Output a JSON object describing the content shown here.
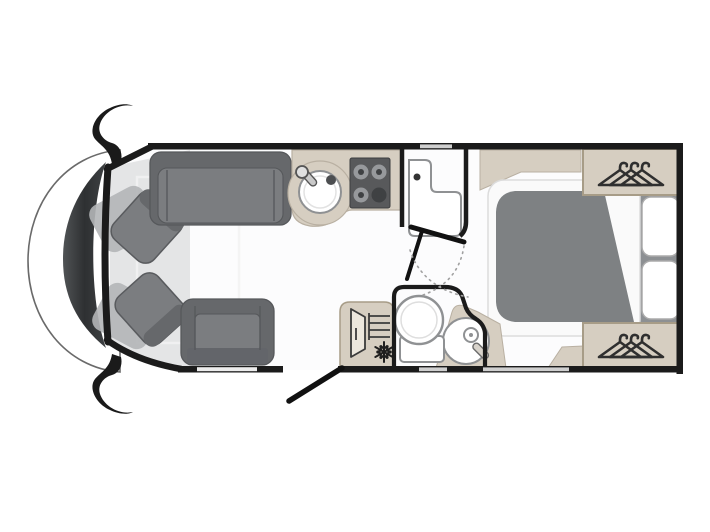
{
  "app": {
    "name": "Motorhome floor plan",
    "description": "Top-down 2D layout drawing of a coachbuilt motorhome: driver cab with two swivel seats on the left, front lounge with sofa and travel seat, mid kitchenette with round sink and 4-burner hob, central washroom with corner basin, shower room with toilet, shower and fridge, rear bedroom with island bed, two pillows and two wardrobes with clothes hangers, open habitation entry door at the bottom"
  },
  "colors": {
    "background": "#ffffff",
    "wall": "#1b1b1b",
    "window": "#cfcfcf",
    "window_light": "#ececec",
    "floor": "#fcfcfd",
    "cab_floor": "#e4e5e6",
    "windshield": "#3e4042",
    "furniture_dark": "#66686b",
    "furniture_mid": "#7b7d80",
    "furniture_ghost": "#b3b5b7",
    "cabinet": "#d6cec1",
    "cabinet_border": "#a79c87",
    "fixture_white": "#ffffff",
    "fixture_stroke": "#8f9193",
    "bed_duvet": "#7e8183",
    "bed_panel": "#8d9093",
    "bed_mattress": "#fafafa",
    "hob": "#58595b",
    "burner_ring": "#97999c",
    "burner_dot": "#3f4143",
    "icon_stroke": "#2f2f2f",
    "arc_dotted": "#a0a0a0"
  },
  "zones": [
    {
      "id": "cab",
      "label": "Driver cab",
      "items": [
        "windshield-dashboard",
        "side-mirror-top",
        "side-mirror-bottom",
        "swivel-seat-top",
        "swivel-seat-bottom"
      ]
    },
    {
      "id": "lounge",
      "label": "Front lounge",
      "items": [
        "sofa-bench",
        "travel-seat"
      ]
    },
    {
      "id": "kitchen",
      "label": "Kitchenette",
      "items": [
        "worktop",
        "round-sink",
        "hob-4-burner"
      ]
    },
    {
      "id": "washroom",
      "label": "Washroom",
      "items": [
        "corner-vanity-basin",
        "swing-door",
        "door-swing-arcs"
      ]
    },
    {
      "id": "shower-room",
      "label": "Shower room",
      "items": [
        "fridge-with-snowflake",
        "toilet",
        "shower-with-handset"
      ]
    },
    {
      "id": "bedroom",
      "label": "Rear bedroom",
      "items": [
        "island-bed-with-duvet",
        "pillow",
        "pillow",
        "wardrobe-with-hangers-top",
        "wardrobe-with-hangers-bottom",
        "overhead-lockers"
      ]
    },
    {
      "id": "entrance",
      "label": "Habitation entry",
      "items": [
        "open-door-leaf"
      ]
    }
  ],
  "icons": [
    {
      "name": "sink-icon",
      "meaning": "round kitchen sink with swivel tap"
    },
    {
      "name": "hob-icon",
      "meaning": "four burner gas hob"
    },
    {
      "name": "fridge-icon",
      "meaning": "fridge with open door, shelves and snowflake"
    },
    {
      "name": "snowflake-icon",
      "meaning": "freezer / cooling"
    },
    {
      "name": "toilet-icon",
      "meaning": "swivel cassette toilet"
    },
    {
      "name": "shower-icon",
      "meaning": "shower tray with handset"
    },
    {
      "name": "basin-icon",
      "meaning": "L-shaped vanity basin"
    },
    {
      "name": "hanger-icon",
      "meaning": "wardrobe clothes hangers"
    },
    {
      "name": "side-mirror-icon",
      "meaning": "cab exterior mirror"
    }
  ]
}
